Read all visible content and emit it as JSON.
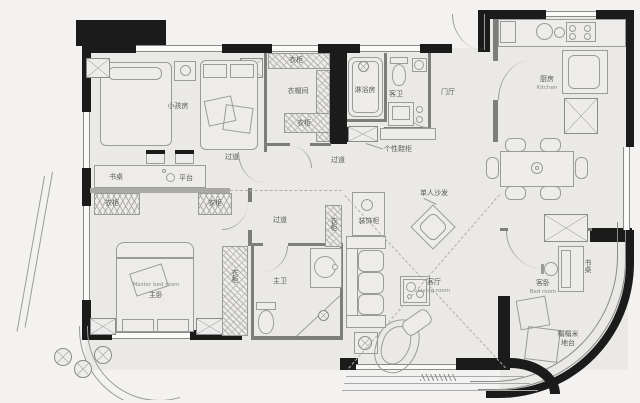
{
  "rooms": {
    "kids": {
      "name": "小孩房"
    },
    "cloak": {
      "name": "衣帽间"
    },
    "shower": {
      "name": "淋浴房"
    },
    "guest_bath": {
      "name": "客卫"
    },
    "foyer": {
      "name": "门厅"
    },
    "kitchen": {
      "name": "厨房",
      "name_en": "Kitchen"
    },
    "living": {
      "name": "客厅",
      "name_en": "Living room"
    },
    "master": {
      "name": "主卧",
      "name_en": "Master bed room"
    },
    "master_bath": {
      "name": "主卫"
    },
    "guest_bed": {
      "name": "客卧",
      "name_en": "Bed room"
    },
    "hallway": {
      "name": "过道"
    }
  },
  "fixtures": {
    "wardrobe": "衣柜",
    "book_desk": "书桌",
    "platform": "平台",
    "deco_cabinet": "装饰柜",
    "single_sofa": "单人沙发",
    "shoe_cabinet": "个性鞋柜",
    "desk": "书桌",
    "tatami_line1": "榻榻米",
    "tatami_line2": "地台"
  },
  "colors": {
    "wall": "#1b1b1b",
    "floor": "#eae9e6",
    "furniture_line": "#9b9b99",
    "label_text": "#5a5a58"
  }
}
